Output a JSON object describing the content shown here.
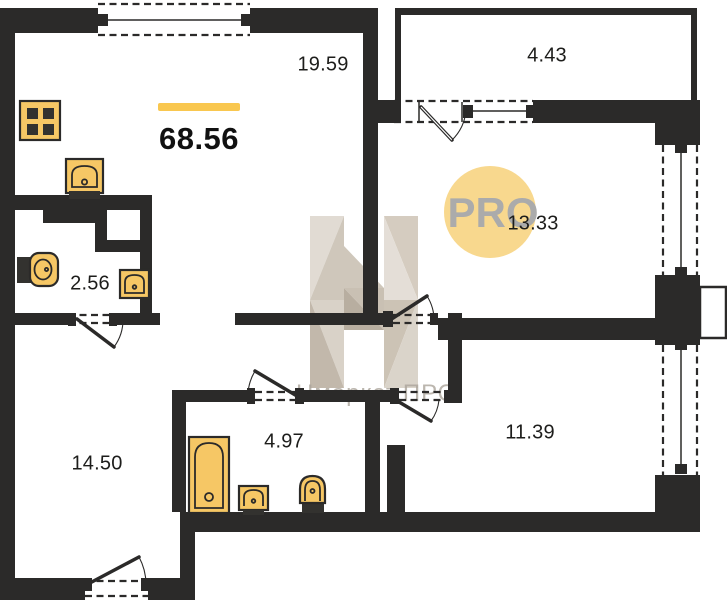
{
  "plan": {
    "total_area": "68.56",
    "rooms": [
      {
        "name": "kitchen-living",
        "area": "19.59"
      },
      {
        "name": "balcony",
        "area": "4.43"
      },
      {
        "name": "bedroom-upper",
        "area": "13.33"
      },
      {
        "name": "wc",
        "area": "2.56"
      },
      {
        "name": "hall-room",
        "area": "14.50"
      },
      {
        "name": "bathroom",
        "area": "4.97"
      },
      {
        "name": "bedroom-lower",
        "area": "11.39"
      }
    ],
    "fixtures": [
      "stove",
      "kitchen-sink",
      "wc-toilet",
      "wc-sink",
      "bathtub",
      "bathroom-sink",
      "bathroom-toilet"
    ],
    "windows_count": 4,
    "doors_count": 6
  },
  "watermark": {
    "badge_text": "PRO",
    "brand_text": "Нмаркет.ПРО"
  },
  "colors": {
    "wall": "#2b2a29",
    "fixture_fill": "#f6c765",
    "accent_yellow": "#f9c74f",
    "badge_fill": "#f8d88e",
    "badge_text": "#ababab",
    "label_text": "#1d1d1b"
  }
}
